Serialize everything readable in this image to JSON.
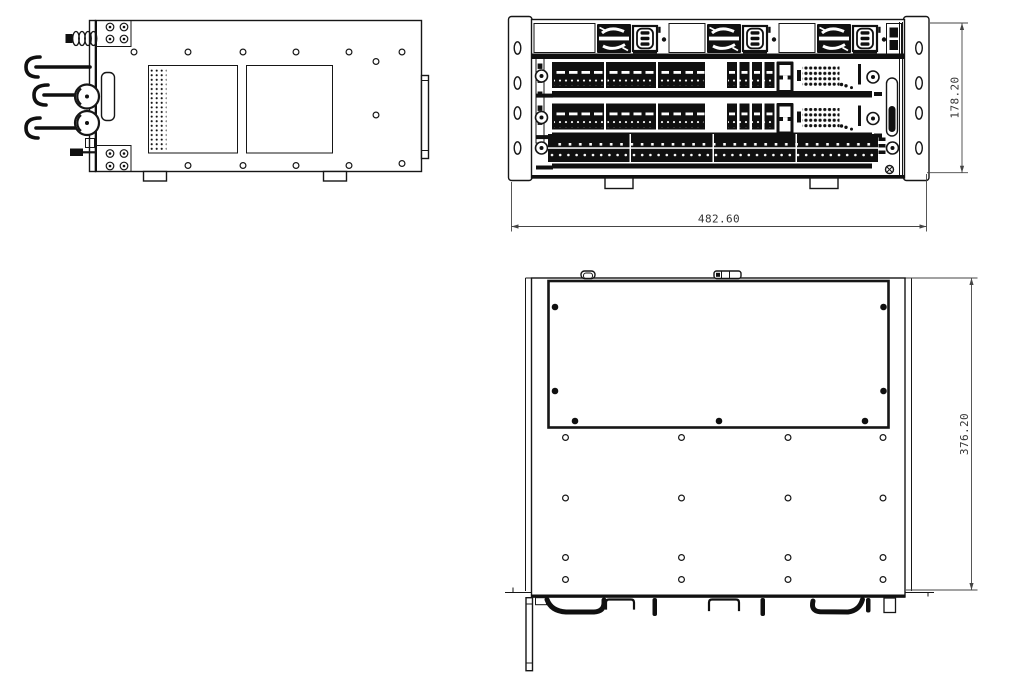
{
  "drawing": {
    "dimensions": {
      "front_height": "178.20",
      "front_width": "482.60",
      "top_depth": "376.20"
    },
    "colors": {
      "line": "#161616",
      "background": "#ffffff",
      "dimension_line": "#454545",
      "dimension_text": "#333333"
    }
  }
}
